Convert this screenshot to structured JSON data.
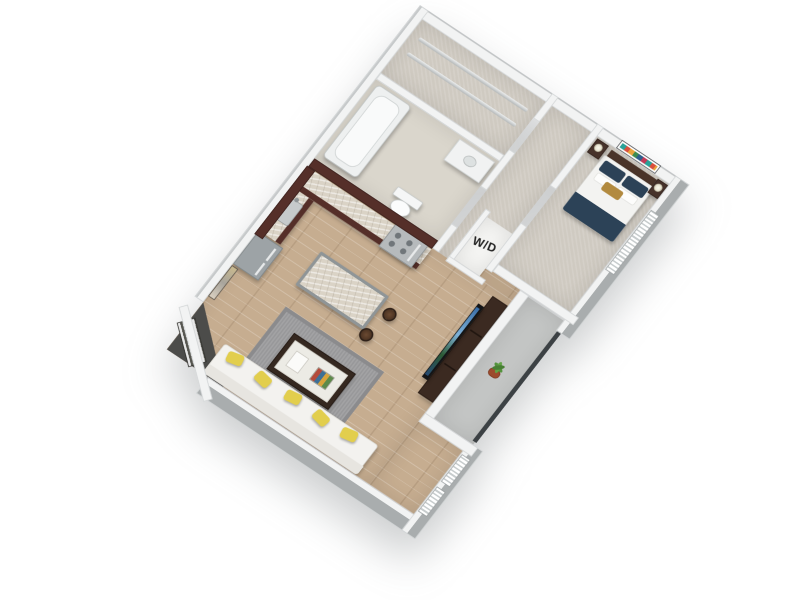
{
  "labels": {
    "washer_dryer": "W/D"
  },
  "theme": {
    "colors": {
      "background": "#ffffff",
      "wallTop": "#f2f3f3",
      "wallEdge": "#d2d5d6",
      "wallOuter": "#a9adae",
      "wallOuterLight": "#c6c9ca",
      "floorWood": "#c6ad90",
      "floorCarpet": "#cfcac1",
      "floorTile": "#dad6cc",
      "floorBalcony": "#c3c5c4",
      "cabinet": "#552f29",
      "cabinetDark": "#3b211d",
      "counter": "#dad3c6",
      "stainless": "#b6babc",
      "fridge": "#9da3a6",
      "islandBase": "#8f9597",
      "sofa": "#f3f2ef",
      "pillowYellow": "#e2ce4d",
      "rug": "#98989a",
      "tableWood": "#352820",
      "tableTop": "#ecebe5",
      "bedNavy": "#2c4257",
      "bedGold": "#b28a3f",
      "headboard": "#4a3429",
      "tvBlack": "#141517",
      "plantGreen": "#53923c",
      "potTerracotta": "#9c4b2d",
      "railing": "#3c4144"
    }
  }
}
